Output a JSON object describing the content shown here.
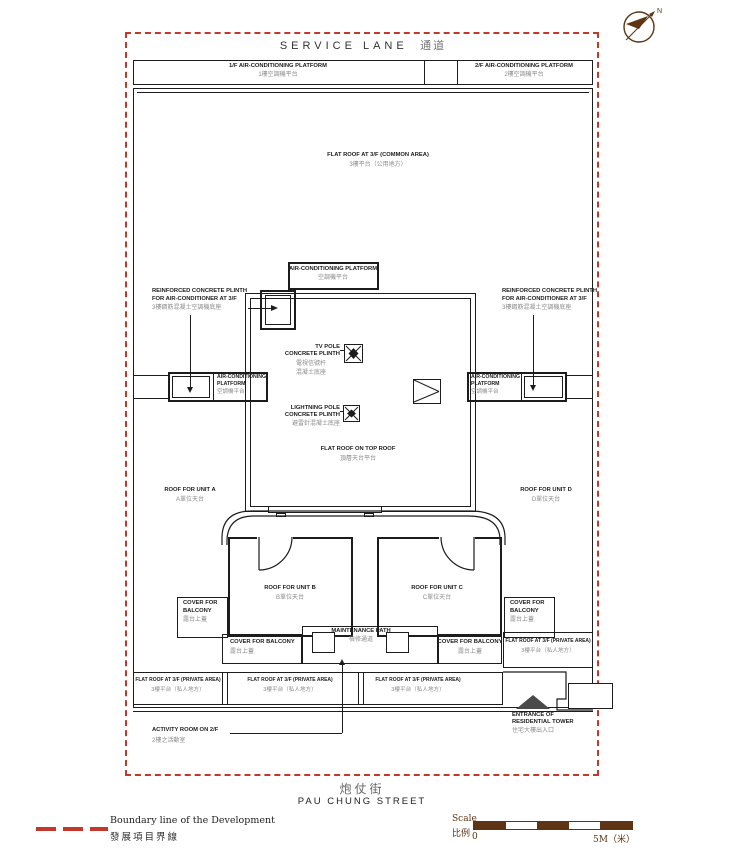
{
  "colors": {
    "boundary_red": "#c4382c",
    "line_ink": "#1c1c1c",
    "muted_gray": "#8b8b8b",
    "compass_brown": "#5e3414"
  },
  "compass": {
    "north": "N"
  },
  "top": {
    "service_lane_en": "SERVICE LANE",
    "service_lane_zh": "通道",
    "ac_1f_en": "1/F AIR-CONDITIONING PLATFORM",
    "ac_1f_zh": "1樓空調機平台",
    "ac_2f_en": "2/F AIR-CONDITIONING PLATFORM",
    "ac_2f_zh": "2樓空調機平台"
  },
  "plan": {
    "flat_roof_common_en": "FLAT ROOF AT 3/F (COMMON AREA)",
    "flat_roof_common_zh": "3樓平台（公用地方）",
    "ac_platform_en": "AIR-CONDITIONING PLATFORM",
    "ac_platform_line1": "AIR-CONDITIONING",
    "ac_platform_line2": "PLATFORM",
    "ac_platform_zh": "空調機平台",
    "plinth_line1": "REINFORCED CONCRETE PLINTH",
    "plinth_line2": "FOR AIR-CONDITIONER AT 3/F",
    "plinth_zh": "3樓鋼筋混凝土空調機底座",
    "tv_pole_line1": "TV POLE",
    "tv_pole_line2": "CONCRETE PLINTH",
    "tv_pole_zh1": "電視信號杆",
    "tv_pole_zh2": "混凝土底座",
    "lightning_line1": "LIGHTNING POLE",
    "lightning_line2": "CONCRETE PLINTH",
    "lightning_zh": "避雷針混凝土底座",
    "top_roof_en": "FLAT ROOF ON TOP ROOF",
    "top_roof_zh": "頂層天台平台",
    "unit_a_en": "ROOF FOR UNIT A",
    "unit_a_zh": "A單位天台",
    "unit_b_en": "ROOF FOR UNIT B",
    "unit_b_zh": "B單位天台",
    "unit_c_en": "ROOF FOR UNIT C",
    "unit_c_zh": "C單位天台",
    "unit_d_en": "ROOF FOR UNIT D",
    "unit_d_zh": "D單位天台",
    "cover_balcony_line1": "COVER FOR",
    "cover_balcony_line2": "BALCONY",
    "cover_balcony_en": "COVER FOR BALCONY",
    "cover_balcony_zh": "露台上蓋",
    "maintenance_en": "MAINTENANCE PATH",
    "maintenance_zh": "檢修通道",
    "private_en": "FLAT ROOF AT 3/F (PRIVATE AREA)",
    "private_zh": "3樓平台（私人地方）",
    "activity_en": "ACTIVITY ROOM ON 2/F",
    "activity_zh": "2樓之活動室",
    "entrance_line1": "ENTRANCE OF",
    "entrance_line2": "RESIDENTIAL TOWER",
    "entrance_zh": "住宅大樓出入口"
  },
  "street": {
    "zh": "炮仗街",
    "en": "PAU CHUNG STREET"
  },
  "legend": {
    "boundary_en": "Boundary line of the Development",
    "boundary_zh": "發展項目界線"
  },
  "scalebar": {
    "label_en": "Scale",
    "label_zh": "比例",
    "zero": "0",
    "max": "5M（米）"
  }
}
